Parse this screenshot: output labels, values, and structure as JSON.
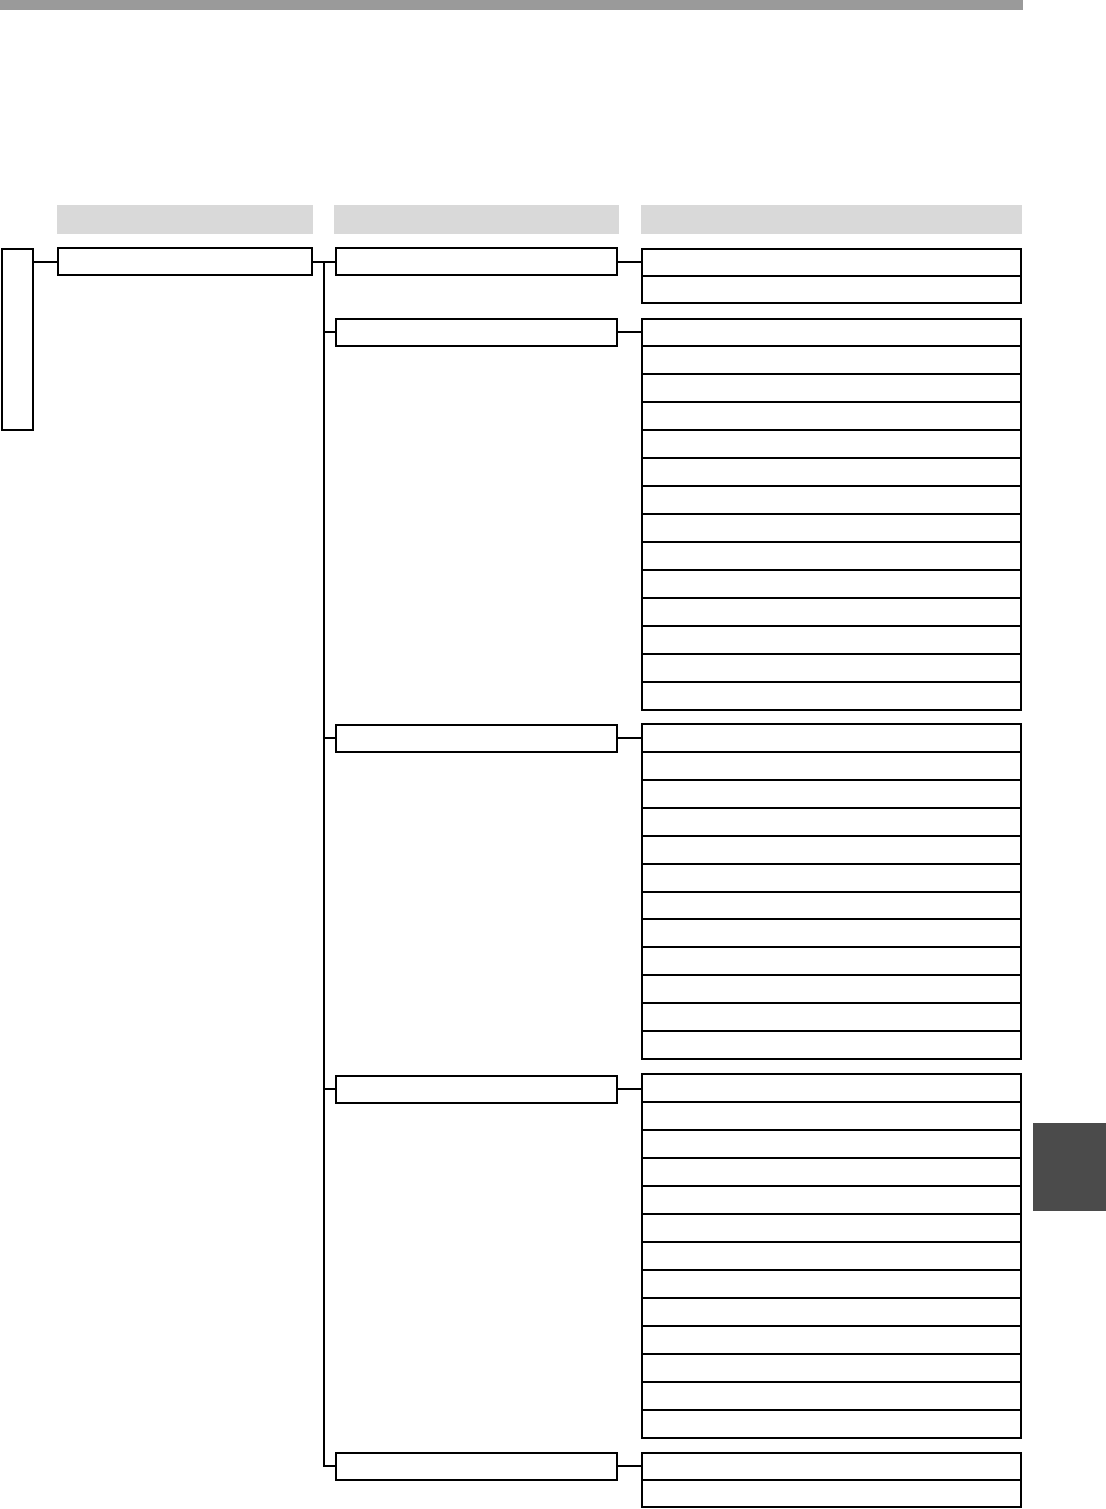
{
  "page": {
    "kind": "menu-tree-diagram-page",
    "background": "#ffffff"
  },
  "colors": {
    "top_rule": "#9a9a9a",
    "header_bar": "#d9d9d9",
    "box_border": "#000000",
    "box_fill": "#ffffff",
    "side_tab": "#4b4b4b"
  },
  "tree": {
    "column_headers": [
      {
        "label": ""
      },
      {
        "label": ""
      },
      {
        "label": ""
      }
    ],
    "root_tab_label": "",
    "level1_boxes": [
      {
        "label": ""
      }
    ],
    "level2_boxes": [
      {
        "label": ""
      },
      {
        "label": ""
      },
      {
        "label": ""
      },
      {
        "label": ""
      },
      {
        "label": ""
      }
    ],
    "level3_groups": [
      {
        "row_count": 2
      },
      {
        "row_count": 14
      },
      {
        "row_count": 12
      },
      {
        "row_count": 13
      },
      {
        "row_count": 2
      }
    ]
  }
}
